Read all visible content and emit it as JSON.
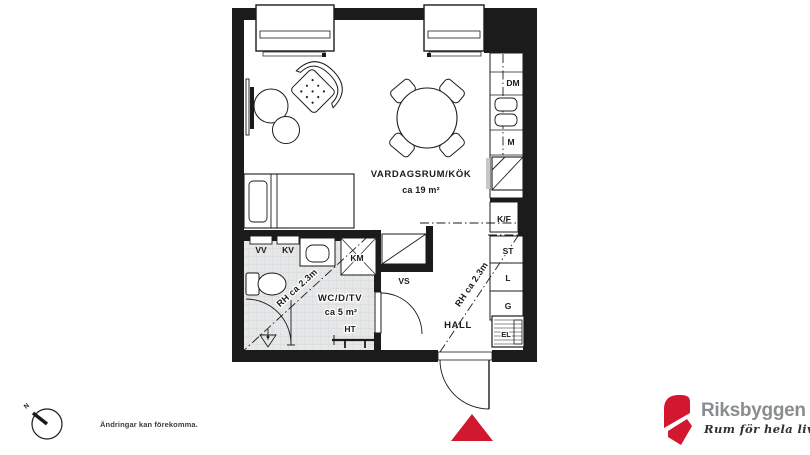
{
  "plan": {
    "living": {
      "name": "VARDAGSRUM/KÖK",
      "area": "ca 19 m²"
    },
    "bathroom": {
      "name": "WC/D/TV",
      "area": "ca 5 m²",
      "height_note": "RH ca 2.3m"
    },
    "hall": {
      "name": "HALL",
      "height_note": "RH ca 2.3m"
    },
    "fixtures": {
      "dm": "DM",
      "m": "M",
      "kf": "K/F",
      "st": "ST",
      "l": "L",
      "g": "G",
      "el": "EL",
      "vs": "VS",
      "vv": "VV",
      "kv": "KV",
      "km": "KM",
      "ht": "HT"
    },
    "compass_north": "N",
    "entrance_marker_color": "#d2182f",
    "wall_color": "#1b1b1b",
    "tile_color": "#e6e7e8"
  },
  "footer": {
    "disclaimer": "Ändringar kan förekomma.",
    "brand": {
      "name": "Riksbyggen",
      "tagline": "Rum för hela livet",
      "logo_red": "#d2182f",
      "name_gray": "#8a8d8f"
    }
  }
}
